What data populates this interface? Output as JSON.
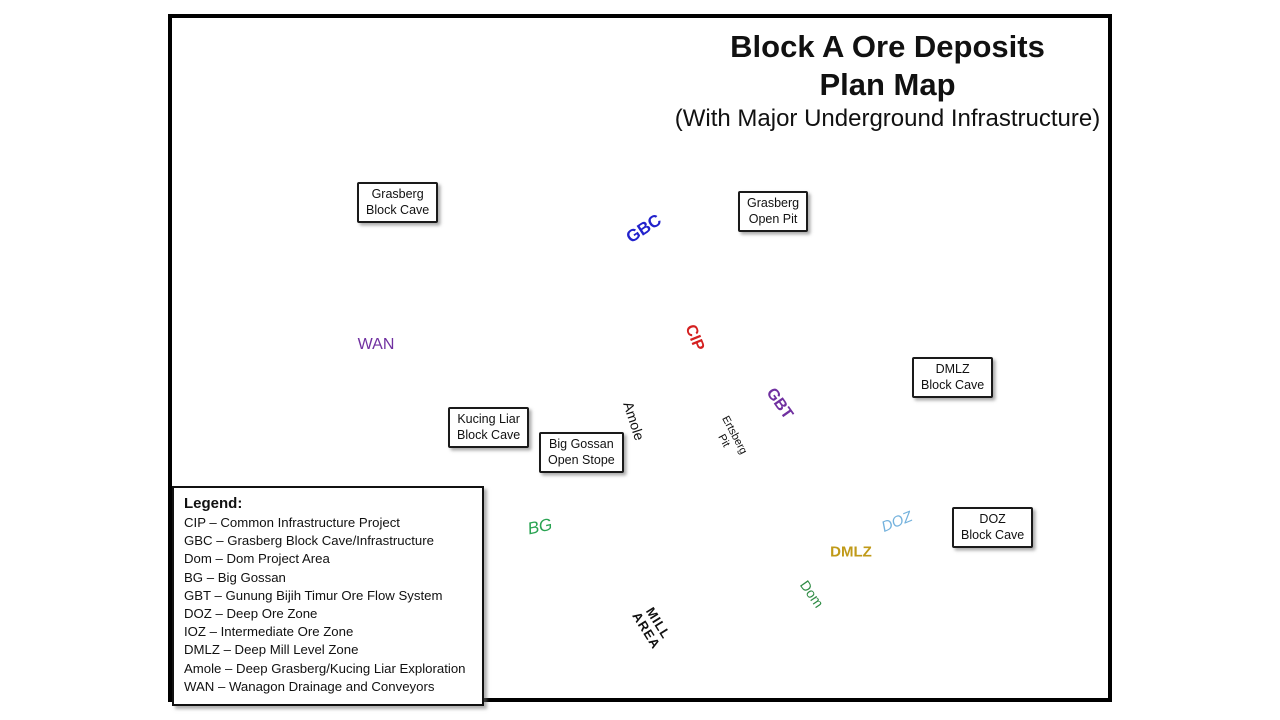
{
  "title": {
    "line1": "Block A Ore Deposits",
    "line2": "Plan Map",
    "line3": "(With Major Underground Infrastructure)"
  },
  "legend": {
    "heading": "Legend:",
    "items": [
      "CIP – Common Infrastructure Project",
      "GBC – Grasberg Block Cave/Infrastructure",
      "Dom – Dom Project Area",
      "BG – Big Gossan",
      "GBT – Gunung Bijih Timur Ore Flow System",
      "DOZ – Deep Ore Zone",
      "IOZ – Intermediate Ore Zone",
      "DMLZ – Deep Mill Level Zone",
      "Amole – Deep Grasberg/Kucing Liar Exploration",
      "WAN – Wanagon Drainage and  Conveyors"
    ]
  },
  "callouts": {
    "grasberg_block_cave": {
      "line1": "Grasberg",
      "line2": "Block Cave"
    },
    "grasberg_open_pit": {
      "line1": "Grasberg",
      "line2": "Open Pit"
    },
    "dmlz_block_cave": {
      "line1": "DMLZ",
      "line2": "Block Cave"
    },
    "kucing_liar_block_cave": {
      "line1": "Kucing Liar",
      "line2": "Block Cave"
    },
    "big_gossan_open_stope": {
      "line1": "Big Gossan",
      "line2": "Open Stope"
    },
    "doz_block_cave": {
      "line1": "DOZ",
      "line2": "Block Cave"
    }
  },
  "map_labels": {
    "gbc": "GBC",
    "cip": "CIP",
    "gbt": "GBT",
    "wan": "WAN",
    "amole": "Amole",
    "ertsberg_line1": "Ertsberg",
    "ertsberg_line2": "Pit",
    "bg": "BG",
    "doz": "DOZ",
    "dmlz": "DMLZ",
    "dom": "Dom",
    "mill_line1": "MILL",
    "mill_line2": "AREA"
  },
  "compass": {
    "north": "N"
  },
  "scale_bar": {
    "start": "0",
    "end": "1000",
    "units": "METERS"
  },
  "colors": {
    "gbc_blue": "#2222cc",
    "cip_red": "#d42020",
    "gbt_wan_purple": "#7030a0",
    "bg_green": "#29a352",
    "dom_green": "#2e8b44",
    "doz_lightblue": "#74b2dd",
    "dmlz_gold": "#c09a18",
    "pit_outline_pink": "#d4828e",
    "kucing_cyan": "#42dcd4",
    "dmlz_cave_pink": "#f7ccd4",
    "grasberg_cave_green": "#eef8f0",
    "tan_brown": "#c08850",
    "mill_gray": "#b5a593"
  }
}
